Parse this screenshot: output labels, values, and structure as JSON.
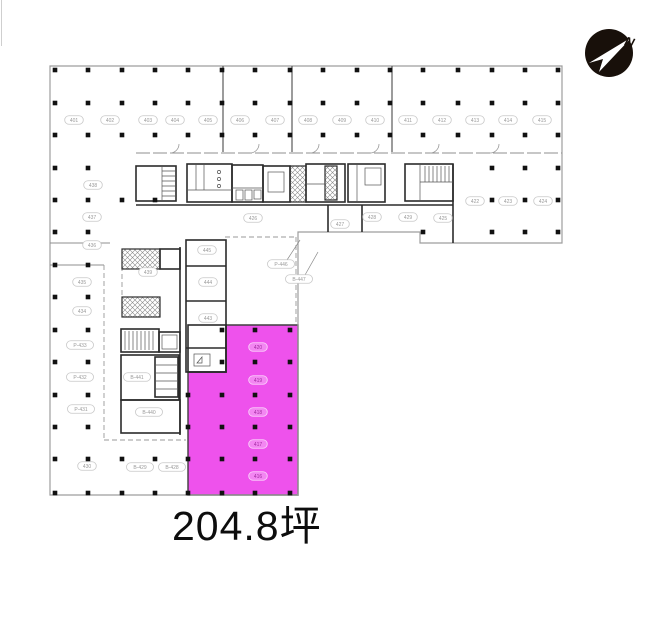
{
  "area_label": {
    "text": "204.8坪"
  },
  "compass": {
    "label": "N"
  },
  "colors": {
    "highlight": "#ee52ec",
    "outline": "#9e9e9e",
    "wall": "#2b2b2b",
    "text": "#0d0d0d",
    "compass": "#18100a"
  },
  "plan": {
    "columns": {
      "size": 4.6,
      "xs": [
        55,
        88,
        122,
        155,
        188,
        222,
        255,
        290,
        323,
        357,
        390,
        423,
        458,
        492,
        525,
        558
      ],
      "ys": [
        70,
        103,
        135,
        168,
        200,
        232,
        265,
        297,
        330,
        362,
        395,
        427,
        459,
        493
      ],
      "rows": [
        "all",
        "all",
        "all",
        [
          0,
          1,
          13,
          14,
          15
        ],
        [
          0,
          1,
          2,
          3,
          13,
          14,
          15
        ],
        [
          0,
          1,
          11,
          13,
          14,
          15
        ],
        [
          0,
          1
        ],
        [
          0,
          1
        ],
        [
          0,
          1,
          5,
          6,
          7
        ],
        [
          0,
          1,
          5,
          6,
          7
        ],
        [
          0,
          1,
          4,
          5,
          6,
          7
        ],
        [
          0,
          1,
          4,
          5,
          6,
          7
        ],
        [
          0,
          1,
          2,
          3,
          4,
          5,
          6,
          7
        ],
        [
          0,
          1,
          2,
          3,
          4,
          5,
          6,
          7
        ]
      ]
    },
    "labels": [
      {
        "x": 74,
        "y": 120,
        "t": "401"
      },
      {
        "x": 110,
        "y": 120,
        "t": "402"
      },
      {
        "x": 148,
        "y": 120,
        "t": "403"
      },
      {
        "x": 175,
        "y": 120,
        "t": "404"
      },
      {
        "x": 208,
        "y": 120,
        "t": "405"
      },
      {
        "x": 240,
        "y": 120,
        "t": "406"
      },
      {
        "x": 275,
        "y": 120,
        "t": "407"
      },
      {
        "x": 308,
        "y": 120,
        "t": "408"
      },
      {
        "x": 342,
        "y": 120,
        "t": "409"
      },
      {
        "x": 375,
        "y": 120,
        "t": "410"
      },
      {
        "x": 408,
        "y": 120,
        "t": "411"
      },
      {
        "x": 442,
        "y": 120,
        "t": "412"
      },
      {
        "x": 475,
        "y": 120,
        "t": "413"
      },
      {
        "x": 508,
        "y": 120,
        "t": "414"
      },
      {
        "x": 542,
        "y": 120,
        "t": "415"
      },
      {
        "x": 93,
        "y": 185,
        "t": "438"
      },
      {
        "x": 92,
        "y": 217,
        "t": "437"
      },
      {
        "x": 92,
        "y": 245,
        "t": "436"
      },
      {
        "x": 82,
        "y": 282,
        "t": "435"
      },
      {
        "x": 82,
        "y": 311,
        "t": "434"
      },
      {
        "x": 80,
        "y": 345,
        "t": "P-433"
      },
      {
        "x": 80,
        "y": 377,
        "t": "P-432"
      },
      {
        "x": 81,
        "y": 409,
        "t": "P-431"
      },
      {
        "x": 87,
        "y": 466,
        "t": "430"
      },
      {
        "x": 140,
        "y": 467,
        "t": "B-429"
      },
      {
        "x": 172,
        "y": 467,
        "t": "B-428"
      },
      {
        "x": 148,
        "y": 272,
        "t": "439"
      },
      {
        "x": 137,
        "y": 377,
        "t": "B-441"
      },
      {
        "x": 149,
        "y": 412,
        "t": "B-440"
      },
      {
        "x": 207,
        "y": 250,
        "t": "445"
      },
      {
        "x": 208,
        "y": 282,
        "t": "444"
      },
      {
        "x": 208,
        "y": 318,
        "t": "443"
      },
      {
        "x": 253,
        "y": 218,
        "t": "426"
      },
      {
        "x": 340,
        "y": 224,
        "t": "427"
      },
      {
        "x": 372,
        "y": 217,
        "t": "428"
      },
      {
        "x": 408,
        "y": 217,
        "t": "429"
      },
      {
        "x": 443,
        "y": 218,
        "t": "425"
      },
      {
        "x": 475,
        "y": 201,
        "t": "422"
      },
      {
        "x": 508,
        "y": 201,
        "t": "423"
      },
      {
        "x": 543,
        "y": 201,
        "t": "424"
      }
    ],
    "annotations": [
      {
        "x": 281,
        "y": 264,
        "t": "P-446",
        "lx": 300,
        "ly": 240
      },
      {
        "x": 299,
        "y": 279,
        "t": "B-447",
        "lx": 318,
        "ly": 252
      }
    ],
    "magenta_labels": [
      {
        "x": 258,
        "y": 347,
        "t": "420"
      },
      {
        "x": 258,
        "y": 380,
        "t": "419"
      },
      {
        "x": 258,
        "y": 412,
        "t": "418"
      },
      {
        "x": 258,
        "y": 444,
        "t": "417"
      },
      {
        "x": 258,
        "y": 476,
        "t": "416"
      }
    ]
  }
}
